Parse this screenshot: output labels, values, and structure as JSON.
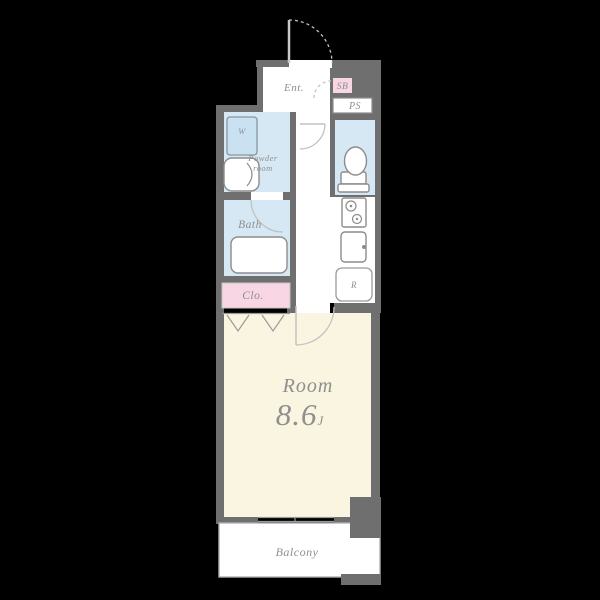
{
  "colors": {
    "bg": "#000000",
    "wall": "#6f6f6f",
    "floor-white": "#ffffff",
    "room-cream": "#f9f5e0",
    "wet-blue": "#d5e8f4",
    "washer-blue": "#c9e1f0",
    "pink": "#f8d6e3",
    "line": "#9a9a9a",
    "fixture": "#8c8c8c",
    "door-arc": "#c2c2c2",
    "balcony-line": "#b0b0b0",
    "text": "#8f8f8f"
  },
  "rooms": {
    "entrance": {
      "label": "Ent."
    },
    "shoe_box": {
      "label": "SB"
    },
    "pipe_space": {
      "label": "PS"
    },
    "washer": {
      "label": "W"
    },
    "powder_room": {
      "line1": "Powder",
      "line2": "room"
    },
    "bath": {
      "label": "Bath"
    },
    "closet": {
      "label": "Clo."
    },
    "kitchen": {
      "refrigerator_label": "R"
    },
    "main_room": {
      "label": "Room",
      "area": "8.6",
      "area_unit": "J"
    },
    "balcony": {
      "label": "Balcony"
    }
  }
}
